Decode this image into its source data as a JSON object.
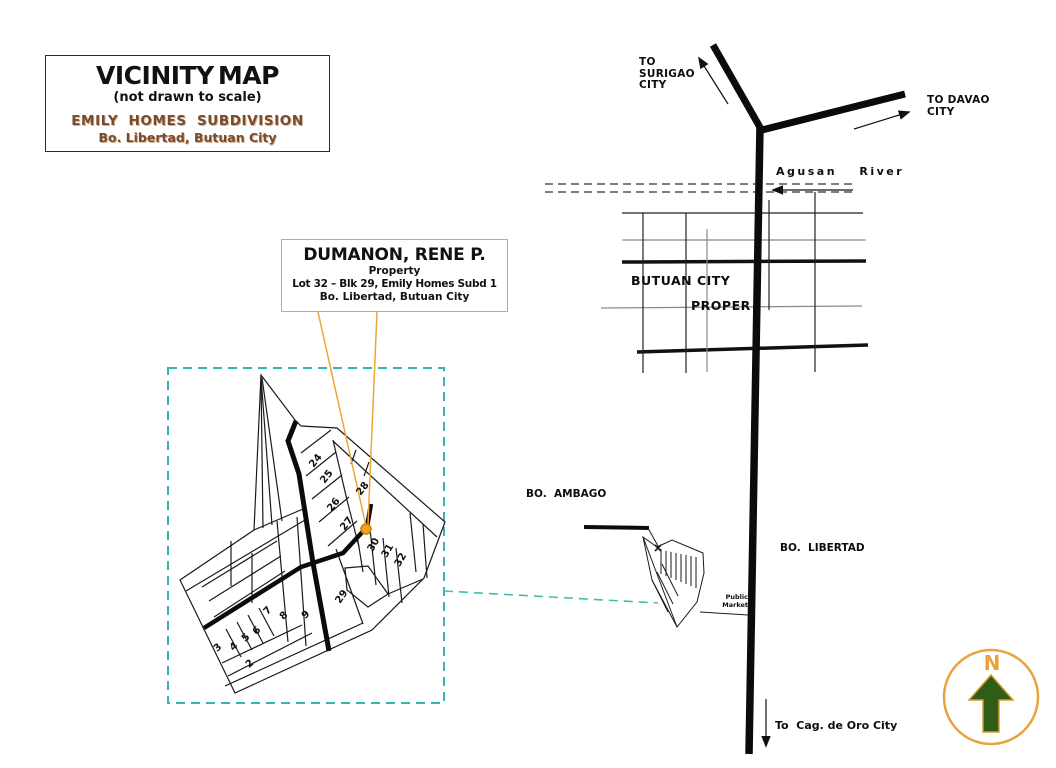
{
  "title_box": {
    "title": "VICINITY MAP",
    "subtitle": "(not drawn to scale)",
    "subdivision": "EMILY HOMES SUBDIVISION",
    "location": "Bo. Libertad, Butuan City"
  },
  "property_box": {
    "owner": "DUMANON, RENE P.",
    "line2": "Property",
    "line3": "Lot 32 – Blk 29, Emily Homes Subd 1",
    "line4": "Bo. Libertad, Butuan City"
  },
  "map_labels": {
    "to_surigao": "TO\nSURIGAO\nCITY",
    "to_davao": "TO DAVAO\nCITY",
    "agusan_river": "Agusan River",
    "butuan_city": "BUTUAN CITY",
    "proper": "PROPER",
    "bo_ambago": "BO.  AMBAGO",
    "bo_libertad": "BO.  LIBERTAD",
    "public_market": "Public\nMarket",
    "to_cagayan": "To  Cag. de Oro City",
    "compass_north": "N"
  },
  "plat": {
    "lots": [
      {
        "label": "24"
      },
      {
        "label": "25"
      },
      {
        "label": "26"
      },
      {
        "label": "27"
      },
      {
        "label": "28"
      },
      {
        "label": "29"
      },
      {
        "label": "30"
      },
      {
        "label": "31"
      },
      {
        "label": "32"
      },
      {
        "label": "2"
      },
      {
        "label": "3"
      },
      {
        "label": "4"
      },
      {
        "label": "5"
      },
      {
        "label": "6"
      },
      {
        "label": "7"
      },
      {
        "label": "8"
      },
      {
        "label": "9"
      }
    ]
  },
  "colors": {
    "accent_orange": "#F0A437",
    "property_dot": "#F5A11E",
    "teal_dash": "#35B5AB",
    "brown_text": "#7B4A2B",
    "compass_green": "#2F5D17",
    "river_gray": "#7e7e7e"
  }
}
